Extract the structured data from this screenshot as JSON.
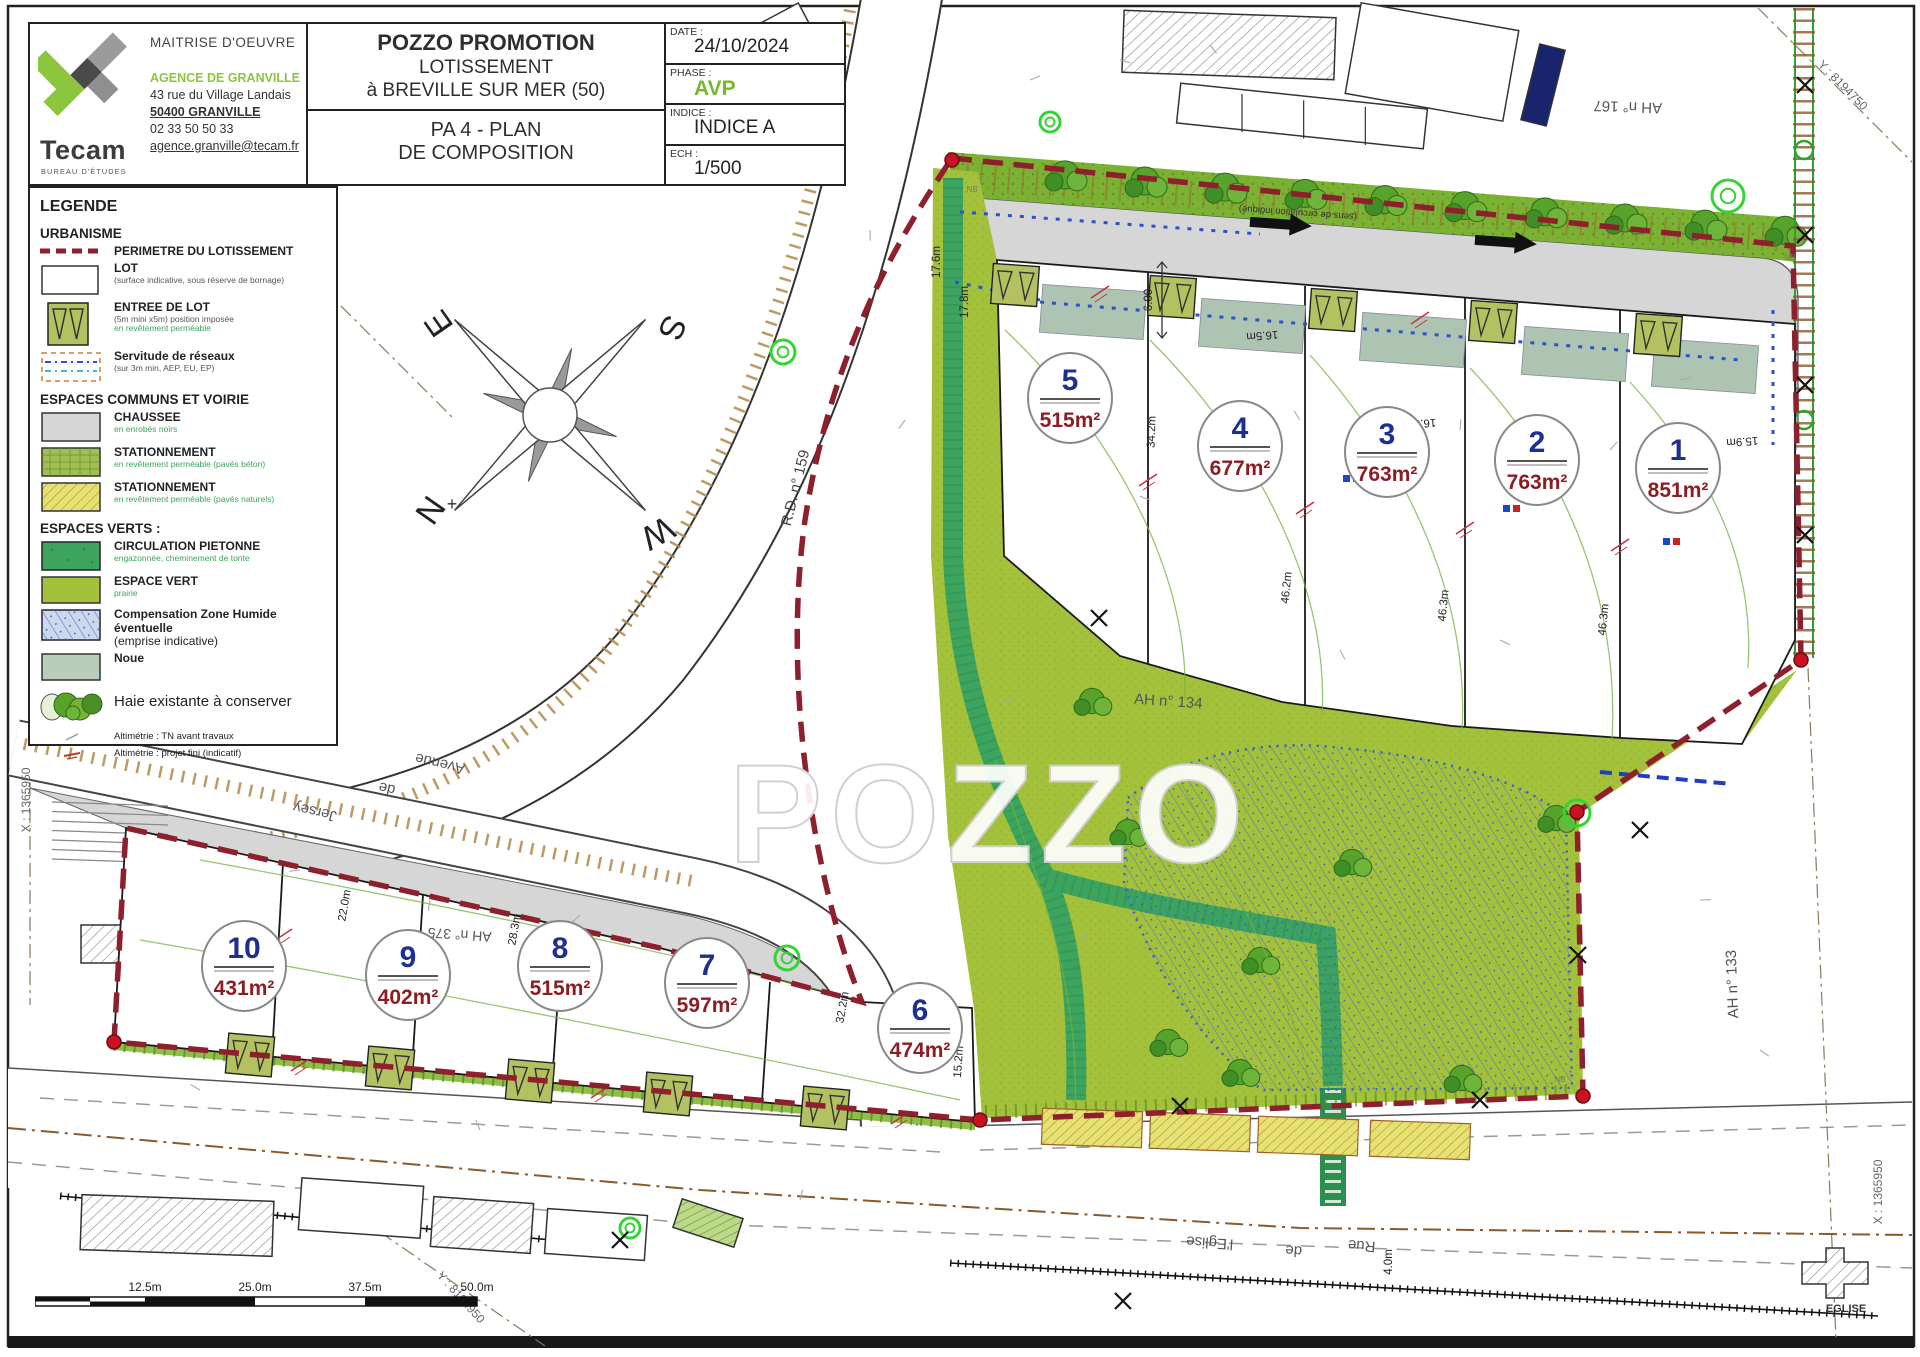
{
  "title_block": {
    "maitrise": "MAITRISE D'OEUVRE",
    "logo": "Tecam",
    "logo_sub": "BUREAU D'ÉTUDES",
    "agence": "AGENCE DE GRANVILLE",
    "address": "43 rue du Village Landais",
    "city": "50400 GRANVILLE",
    "phone": "02 33 50 50 33",
    "email": "agence.granville@tecam.fr",
    "client": "POZZO PROMOTION",
    "project_line1": "LOTISSEMENT",
    "project_line2": "à BREVILLE SUR MER (50)",
    "doc_line1": "PA 4 - PLAN",
    "doc_line2": "DE COMPOSITION",
    "fields": [
      {
        "label": "DATE :",
        "value": "24/10/2024"
      },
      {
        "label": "PHASE :",
        "value": "AVP"
      },
      {
        "label": "INDICE :",
        "value": "INDICE A"
      },
      {
        "label": "ECH :",
        "value": "1/500"
      }
    ]
  },
  "legend": {
    "title": "LEGENDE",
    "sections": [
      {
        "heading": "URBANISME",
        "items": [
          {
            "label": "PERIMETRE DU LOTISSEMENT"
          },
          {
            "label": "LOT",
            "sub": "(surface indicative, sous réserve de bornage)"
          },
          {
            "label": "ENTREE DE LOT",
            "sub": "(5m mini  x5m) position imposée",
            "subg": "en revêtement perméable"
          },
          {
            "label": "Servitude de réseaux",
            "sub": "(sur 3m min, AEP, EU, EP)"
          }
        ]
      },
      {
        "heading": "ESPACES COMMUNS ET VOIRIE",
        "items": [
          {
            "label": "CHAUSSEE",
            "subg": "en enrobés noirs"
          },
          {
            "label": "STATIONNEMENT",
            "subg": "en revêtement perméable  (pavés béton)"
          },
          {
            "label": "STATIONNEMENT",
            "subg": "en revêtement perméable  (pavés naturels)"
          }
        ]
      },
      {
        "heading": "ESPACES VERTS :",
        "items": [
          {
            "label": "CIRCULATION PIETONNE",
            "subg": "engazonnée, cheminement de tonte"
          },
          {
            "label": "ESPACE VERT",
            "subg": "prairie"
          },
          {
            "label": "Compensation Zone Humide éventuelle",
            "label2": "(emprise indicative)"
          },
          {
            "label": "Noue"
          }
        ]
      },
      {
        "heading": null,
        "items": [
          {
            "label": "Haie existante à conserver"
          },
          {
            "label": "Altimétrie : TN avant travaux"
          },
          {
            "label": "Altimétrie : projet fini (indicatif)"
          }
        ]
      }
    ]
  },
  "lots": [
    {
      "num": "1",
      "area": "851m²"
    },
    {
      "num": "2",
      "area": "763m²"
    },
    {
      "num": "3",
      "area": "763m²"
    },
    {
      "num": "4",
      "area": "677m²"
    },
    {
      "num": "5",
      "area": "515m²"
    },
    {
      "num": "6",
      "area": "474m²"
    },
    {
      "num": "7",
      "area": "597m²"
    },
    {
      "num": "8",
      "area": "515m²"
    },
    {
      "num": "9",
      "area": "402m²"
    },
    {
      "num": "10",
      "area": "431m²"
    }
  ],
  "map": {
    "watermark": "POZZO",
    "compass": {
      "n": "N",
      "s": "S",
      "e": "E",
      "w": "W"
    },
    "note_direction": "(sens de circulation indiqué)",
    "nb": "NB",
    "church": "EGLISE",
    "parcels": [
      "AH n° 167",
      "AH n° 134",
      "AH n° 375",
      "AH n° 133"
    ],
    "road_rd": "R.D. n° 159",
    "avenue": [
      "Avenue",
      "de",
      "Jersey"
    ],
    "rue": [
      "Rue",
      "de",
      "l'Eglise"
    ],
    "coords": {
      "top_left": "Y : 8194900",
      "top_right": "Y : 8194750",
      "bottom": "Y : 8194950",
      "left": "X : 1365950",
      "right": "X : 1365950"
    },
    "dims": [
      "17.8m",
      "17.6m",
      "34.2m",
      "46.2m",
      "46.3m",
      "46.3m",
      "22.0m",
      "28.3m",
      "32.2m",
      "15.2m",
      "16.5m",
      "16.5m",
      "15.9m",
      "4.0m",
      "6.00"
    ]
  },
  "scale_bar": {
    "labels": [
      "12.5m",
      "25.0m",
      "37.5m",
      "50.0m"
    ]
  },
  "colors": {
    "perimeter": "#8e1f2c",
    "espace_vert": "#a4c13c",
    "pietonne": "#3ca45e",
    "chaussee": "#d6d6d6",
    "noue": "#aec4b2",
    "stationnement_beton": "#9fbf53",
    "stationnement_naturel": "#e6e173",
    "phase_accent": "#76b82a",
    "logo_green": "#8cc63f",
    "lot_number": "#1d2f8f",
    "lot_area": "#8c1d23"
  }
}
